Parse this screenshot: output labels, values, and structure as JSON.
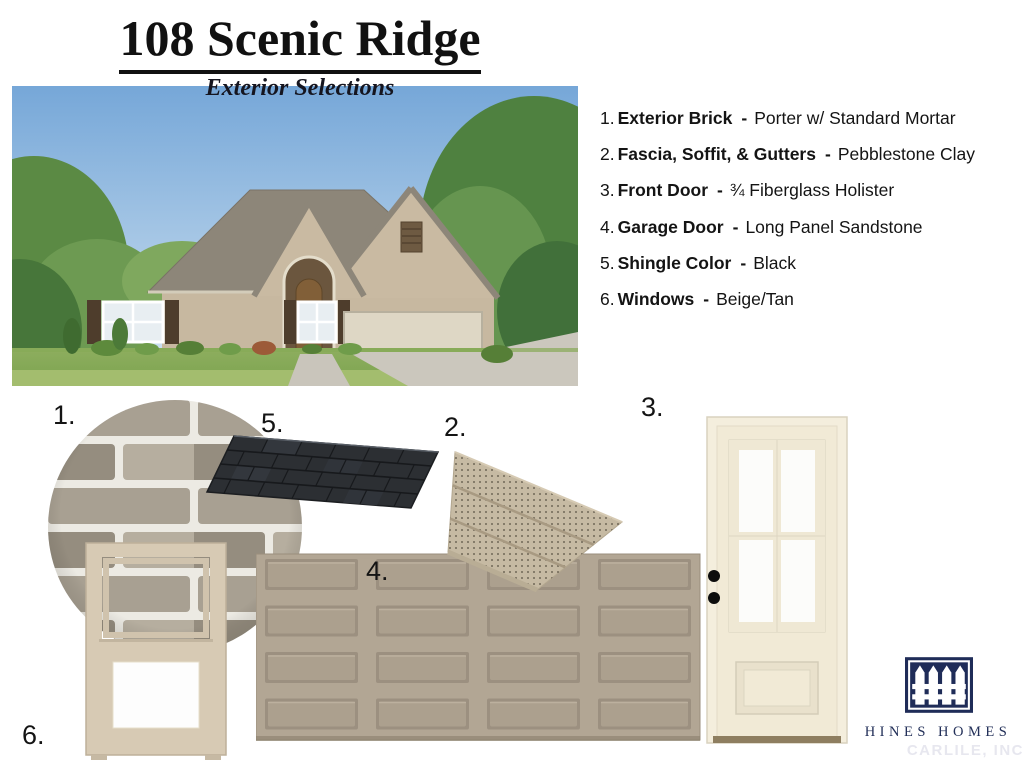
{
  "header": {
    "title": "108 Scenic Ridge",
    "subtitle": "Exterior Selections"
  },
  "selections": [
    {
      "num": "1.",
      "label": "Exterior Brick",
      "sep": "-",
      "value": "Porter w/ Standard Mortar"
    },
    {
      "num": "2.",
      "label": "Fascia, Soffit, & Gutters",
      "sep": "-",
      "value": "Pebblestone Clay"
    },
    {
      "num": "3.",
      "label": "Front Door",
      "sep": "-",
      "value": "¾ Fiberglass Holister"
    },
    {
      "num": "4.",
      "label": "Garage Door",
      "sep": "-",
      "value": "Long Panel Sandstone"
    },
    {
      "num": "5.",
      "label": "Shingle Color",
      "sep": "-",
      "value": "Black"
    },
    {
      "num": "6.",
      "label": "Windows",
      "sep": "-",
      "value": "Beige/Tan"
    }
  ],
  "samples": {
    "brick_marker": "1.",
    "soffit_marker": "2.",
    "door_marker": "3.",
    "garage_marker": "4.",
    "shingle_marker": "5.",
    "window_marker": "6."
  },
  "logo": {
    "name": "HINES HOMES",
    "watermark": "CARLILE, INC"
  },
  "colors": {
    "brand_navy": "#1f2c58",
    "brick_gray": "#a8a092",
    "mortar_white": "#eceae3",
    "shingle_black": "#2c2f33",
    "soffit_clay": "#c6baa3",
    "garage_sandstone": "#b2a694",
    "door_cream": "#f1ead6",
    "window_tan": "#d7cab4"
  }
}
